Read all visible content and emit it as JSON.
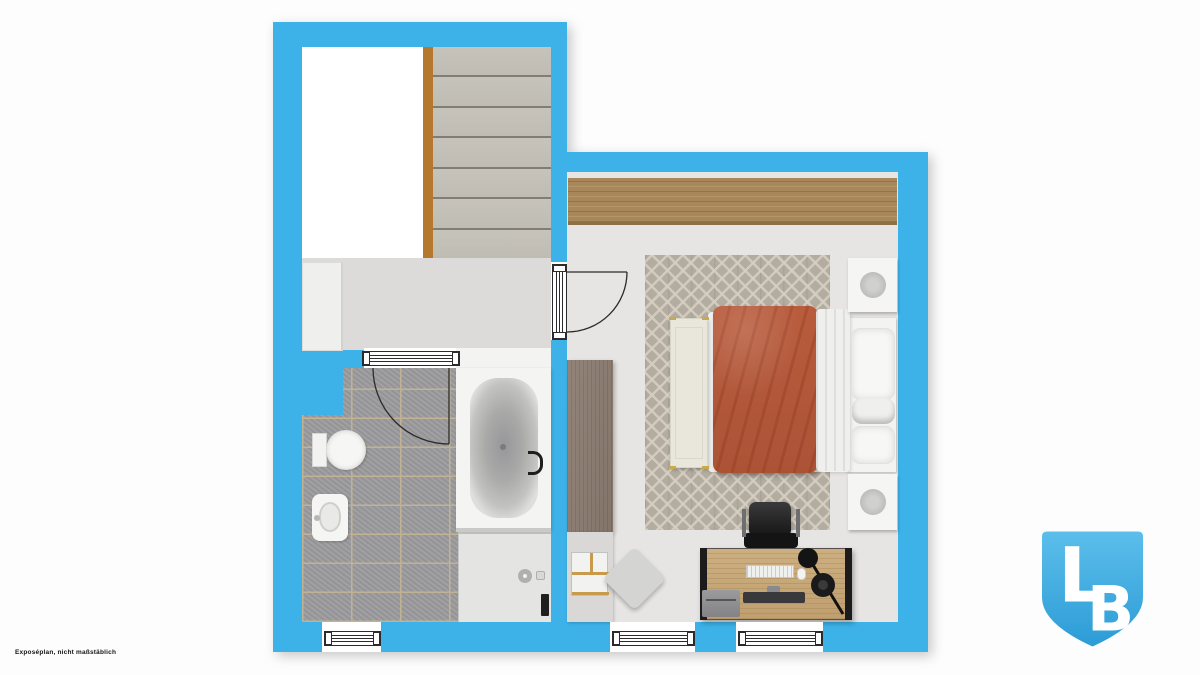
{
  "disclaimer": "Exposéplan, nicht maßstäblich",
  "logo": {
    "letter_l": "L",
    "letter_b": "B"
  },
  "colors": {
    "bg": "#FDFDFD",
    "wall": "#3CB2E8",
    "hallFloor": "#DCDBD9",
    "bedroomFloor": "#E6E5E3",
    "tile": "#9C9C9E",
    "grout": "#C2B294",
    "step": "#C6C3BB",
    "stringer": "#B5792D",
    "wood": "#A8885A",
    "deskWood": "#C9AC7E",
    "rugBase": "#B3ACA0",
    "duvet": "#B95C3D",
    "bench": "#E9E7DB",
    "cabinetTall": "#8B7C71",
    "frameStroke": "#2B2B2B",
    "logoTop": "#5CBEEB",
    "logoBottom": "#2C9CD6"
  }
}
